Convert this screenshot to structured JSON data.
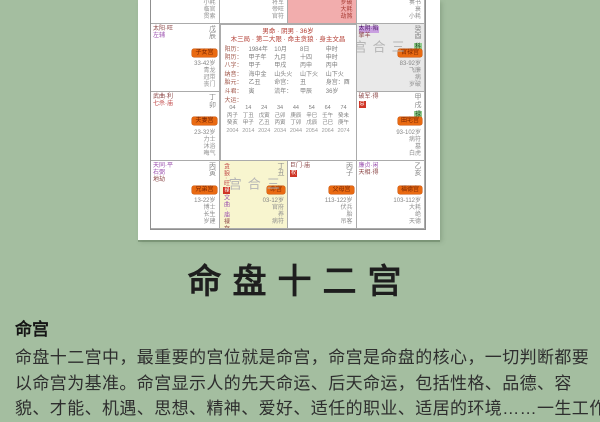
{
  "title": "命盘十二宫",
  "article": {
    "heading": "命宫",
    "lines": [
      "命盘十二宫中，最重要的宫位就是命宫，命宫是命盘的核心，一切判断都要",
      "以命宫为基准。命宫显示人的先天命运、后天命运，包括性格、品德、容",
      "貌、才能、机遇、思想、精神、爱好、适任的职业、适居的环境……一生工作"
    ]
  },
  "colors": {
    "page_bg": "#a4bea0",
    "pink_cell": "#f2adad",
    "yellow_cell": "#f8f5cf",
    "gray_cell": "#e9e9e9",
    "orange_tag": "#e96a12",
    "red_chip": "#cf3526",
    "green_chip": "#93cd8f",
    "watermark_gray": "#b5b5b5"
  },
  "chart": {
    "watermark": "三合宫",
    "center": {
      "header1": "男命 · 阴男 · 36岁",
      "header2": "木三局 · 第二大限 · 命主贪狼 · 身主文昌",
      "info_rows": [
        [
          "阳历：",
          "1984年",
          "10月",
          "8日",
          "申时"
        ],
        [
          "阴历：",
          "甲子年",
          "九月",
          "十四",
          "申时"
        ],
        [
          "八字：",
          "甲子",
          "甲戌",
          "丙申",
          "丙申"
        ],
        [
          "纳音：",
          "海中金",
          "山头火",
          "山下火",
          "山下火"
        ],
        [
          "胎元：",
          "乙丑",
          "命宫：",
          "丑",
          "身宫：酉"
        ],
        [
          "斗君：",
          "寅",
          "流年：",
          "甲辰",
          "36岁"
        ]
      ],
      "runs_label": "大运：",
      "runs_rows": [
        [
          "04",
          "14",
          "24",
          "34",
          "44",
          "54",
          "64",
          "74"
        ],
        [
          "丙子",
          "丁丑",
          "戊寅",
          "己卯",
          "庚辰",
          "辛巳",
          "壬午",
          "癸未"
        ],
        [
          "癸亥",
          "甲子",
          "乙丑",
          "丙寅",
          "丁卯",
          "戊辰",
          "己巳",
          "庚午"
        ]
      ],
      "years_row": [
        "2004",
        "2014",
        "2024",
        "2034",
        "2044",
        "2054",
        "2064",
        "2074"
      ]
    },
    "cells": [
      {
        "pos": [
          1,
          1
        ],
        "bg": "#ffffff",
        "stars": [
          {
            "t": "天机·平",
            "c": "#8b4545"
          }
        ],
        "branch": "己巳",
        "tag": "财帛宫",
        "age": "43-52岁",
        "notes": [
          "小耗",
          "临官",
          "贯索"
        ]
      },
      {
        "pos": [
          1,
          2
        ],
        "bg": "#ffffff",
        "stars": [
          {
            "t": "紫微·庙",
            "c": "#9a4fae"
          },
          {
            "t": "文昌",
            "c": "#8b4545"
          }
        ],
        "branch": "庚午",
        "tag": "疾厄宫",
        "age": "53-62岁",
        "notes": [
          "将军",
          "帝旺",
          "官符"
        ]
      },
      {
        "pos": [
          1,
          3
        ],
        "bg": "#f2adad",
        "stars": [
          {
            "t": "破军·陷",
            "c": "#b03a30"
          }
        ],
        "branch": "辛未",
        "branchBoxed": true,
        "tag": "迁移宫",
        "age": "63-72岁",
        "notes": [
          "岁破",
          "大耗",
          "劫煞"
        ],
        "notesColor": "#a63a32"
      },
      {
        "pos": [
          1,
          4
        ],
        "bg": "#ffffff",
        "stars": [
          {
            "t": "天府·得",
            "c": "#8b4545"
          }
        ],
        "branch": "壬申",
        "tag": "交友宫",
        "age": "73-82岁",
        "notes": [
          "奏书",
          "衰",
          "小耗"
        ]
      },
      {
        "pos": [
          2,
          1
        ],
        "bg": "#ffffff",
        "stars": [
          {
            "t": "太阳·旺",
            "c": "#8b4545"
          },
          {
            "t": "左辅",
            "c": "#9a4fae"
          }
        ],
        "branch": "戊辰",
        "tag": "子女宫",
        "age": "33-42岁",
        "notes": [
          "青龙",
          "冠带",
          "丧门"
        ]
      },
      {
        "pos": [
          2,
          4
        ],
        "bg": "#e9e9e9",
        "watermark": true,
        "wmSide": true,
        "stars": [
          {
            "t": "太阴·陷",
            "c": "#4d1a66",
            "pchip": true
          },
          {
            "t": "擎羊",
            "c": "#8b4545"
          }
        ],
        "branch": "癸酉",
        "gchip": "科",
        "tag": "官禄宫",
        "age": "83-92岁",
        "notes": [
          "飞廉",
          "病",
          "岁破"
        ]
      },
      {
        "pos": [
          3,
          1
        ],
        "bg": "#ffffff",
        "stars": [
          {
            "t": "武曲·利",
            "c": "#8b4545"
          },
          {
            "t": "七杀·庙",
            "c": "#c04444"
          }
        ],
        "branch": "丁卯",
        "tag": "夫妻宫",
        "age": "23-32岁",
        "notes": [
          "力士",
          "沐浴",
          "晦气"
        ]
      },
      {
        "pos": [
          3,
          4
        ],
        "bg": "#ffffff",
        "stars": [
          {
            "t": "破军·得",
            "c": "#8b4545"
          }
        ],
        "redChip": "忌",
        "branch": "甲戌",
        "gchip": "禄",
        "tag": "田宅宫",
        "age": "93-102岁",
        "notes": [
          "病符",
          "墓",
          "白虎"
        ]
      },
      {
        "pos": [
          4,
          1
        ],
        "bg": "#ffffff",
        "stars": [
          {
            "t": "天同·平",
            "c": "#9a4fae"
          },
          {
            "t": "右弼",
            "c": "#9a4fae"
          },
          {
            "t": "地劫",
            "c": "#8b4545"
          }
        ],
        "branch": "丙寅",
        "tag": "兄弟宫",
        "age": "13-22岁",
        "notes": [
          "博士",
          "长生",
          "岁建"
        ]
      },
      {
        "pos": [
          4,
          2
        ],
        "bg": "#f8f5cf",
        "watermark": true,
        "starsVertical": true,
        "stars": [
          {
            "t": "贪狼·旺",
            "c": "#c04444"
          },
          {
            "t": "文曲·庙",
            "c": "#9a4fae"
          },
          {
            "t": "禄存",
            "c": "#8b4545"
          }
        ],
        "redChip": "禄",
        "branch": "丁丑",
        "tag": "命宫",
        "age": "03-12岁",
        "notes": [
          "官府",
          "养",
          "病符"
        ]
      },
      {
        "pos": [
          4,
          3
        ],
        "bg": "#ffffff",
        "stars": [
          {
            "t": "巨门·庙",
            "c": "#8b4545"
          }
        ],
        "redChip": "权",
        "branch": "丙子",
        "tag": "父母宫",
        "age": "113-122岁",
        "notes": [
          "伏兵",
          "胎",
          "吊客"
        ]
      },
      {
        "pos": [
          4,
          4
        ],
        "bg": "#ffffff",
        "stars": [
          {
            "t": "廉贞·闲",
            "c": "#9a4fae"
          },
          {
            "t": "天相·得",
            "c": "#8b4545"
          }
        ],
        "branch": "乙亥",
        "tag": "福德宫",
        "age": "103-112岁",
        "notes": [
          "大耗",
          "绝",
          "天德"
        ]
      }
    ]
  }
}
